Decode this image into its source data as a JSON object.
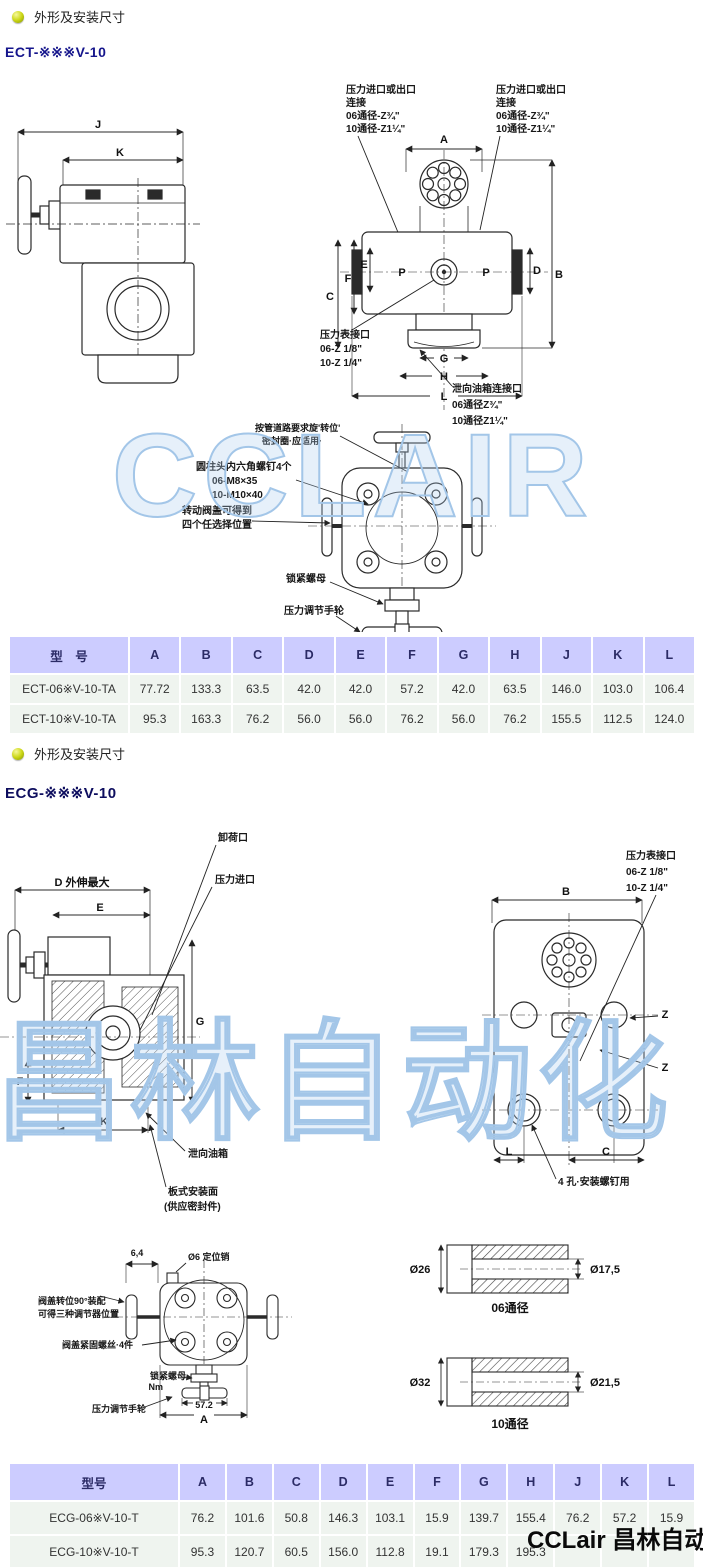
{
  "sections": {
    "s1": {
      "bullet_label": "外形及安装尺寸",
      "heading": "ECT-※※※V-10"
    },
    "s2": {
      "bullet_label": "外形及安装尺寸",
      "heading": "ECG-※※※V-10"
    }
  },
  "ect": {
    "ann": {
      "port": [
        "压力进口或出口",
        "连接",
        "06通径-Z¾\"",
        "10通径-Z1¼\""
      ],
      "gauge": [
        "压力表接口",
        "06-Z 1/8\"",
        "10-Z 1/4\""
      ],
      "drain": [
        "泄向油箱连接口",
        "06通径Z¾\"",
        "10通径Z1¼\""
      ],
      "rotate": [
        "按管道路要求旋'转位'",
        "密封圈·应适用·"
      ],
      "screws": [
        "圆柱头内六角螺钉4个",
        "06-M8×35",
        "10-M10×40"
      ],
      "cover": [
        "转动阀盖可得到",
        "四个任选择位置"
      ],
      "locknut": "锁紧螺母",
      "handwheel": "压力调节手轮",
      "dim527": "52.7"
    },
    "dims": {
      "J": "J",
      "K": "K",
      "A": "A",
      "B": "B",
      "C": "C",
      "D": "D",
      "E": "E",
      "F": "F",
      "G": "G",
      "H": "H",
      "L": "L",
      "P": "P"
    }
  },
  "ecg": {
    "ann": {
      "unload": "卸荷口",
      "inlet": "压力进口",
      "dmax": "D 外伸最大",
      "gauge": [
        "压力表接口",
        "06-Z 1/8\"",
        "10-Z 1/4\""
      ],
      "drain": "泄向油箱",
      "mount": [
        "板式安装面",
        "(供应密封件)"
      ],
      "holes": "4 孔·安装螺钉用",
      "pin_dim": "6,4",
      "pin": "Ø6  定位销",
      "cover90": [
        "阀盖转位90°装配",
        "可得三种调节器位置"
      ],
      "cover_screws": "阀盖紧固螺丝·4件",
      "locknut": "锁紧螺母",
      "nm": "Nm",
      "handwheel": "压力调节手轮",
      "dim572": "57.2"
    },
    "dims": {
      "A": "A",
      "B": "B",
      "C": "C",
      "E": "E",
      "F": "F",
      "G": "G",
      "K": "K",
      "L": "L",
      "Z": "Z"
    },
    "bore06": {
      "outer": "Ø26",
      "inner": "Ø17,5",
      "label": "06通径"
    },
    "bore10": {
      "outer": "Ø32",
      "inner": "Ø21,5",
      "label": "10通径"
    }
  },
  "table1": {
    "headers": [
      "型　号",
      "A",
      "B",
      "C",
      "D",
      "E",
      "F",
      "G",
      "H",
      "J",
      "K",
      "L"
    ],
    "rows": [
      [
        "ECT-06※V-10-TA",
        "77.72",
        "133.3",
        "63.5",
        "42.0",
        "42.0",
        "57.2",
        "42.0",
        "63.5",
        "146.0",
        "103.0",
        "106.4"
      ],
      [
        "ECT-10※V-10-TA",
        "95.3",
        "163.3",
        "76.2",
        "56.0",
        "56.0",
        "76.2",
        "56.0",
        "76.2",
        "155.5",
        "112.5",
        "124.0"
      ]
    ]
  },
  "table2": {
    "headers": [
      "型号",
      "A",
      "B",
      "C",
      "D",
      "E",
      "F",
      "G",
      "H",
      "J",
      "K",
      "L"
    ],
    "rows": [
      [
        "ECG-06※V-10-T",
        "76.2",
        "101.6",
        "50.8",
        "146.3",
        "103.1",
        "15.9",
        "139.7",
        "155.4",
        "76.2",
        "57.2",
        "15.9"
      ],
      [
        "ECG-10※V-10-T",
        "95.3",
        "120.7",
        "60.5",
        "156.0",
        "112.8",
        "19.1",
        "179.3",
        "195.3",
        "",
        "",
        ""
      ]
    ]
  },
  "watermarks": {
    "wm1": "CCLAIR",
    "wm2": "昌林自动化",
    "logo": "CCLair 昌林自动化"
  },
  "colors": {
    "header_bg": "#ccccff",
    "row_bg": "#eff4ef",
    "heading": "#15158c",
    "watermark": "#a3c6e8"
  }
}
